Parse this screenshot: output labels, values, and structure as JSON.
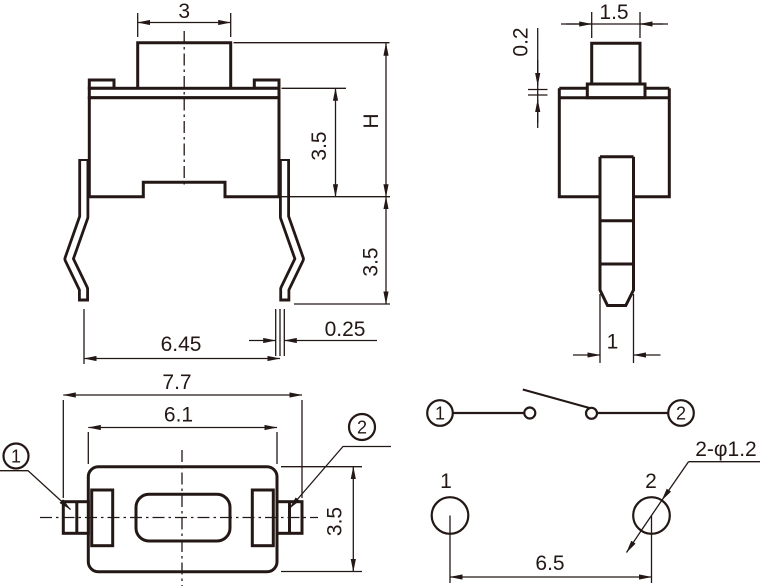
{
  "title": "Tact switch dimensional drawing",
  "colors": {
    "line": "#231815",
    "background": "#ffffff"
  },
  "front_view": {
    "button_width": "3",
    "upper_body_height": "3.5",
    "total_height": "H",
    "leg_length": "3.5",
    "lead_span": "6.45",
    "lead_thickness": "0.25"
  },
  "side_view": {
    "button_width": "1.5",
    "clearance": "0.2",
    "pin_width": "1"
  },
  "plan_view": {
    "overall_width": "7.7",
    "body_width": "6.1",
    "body_depth": "3.5",
    "terminal_1": "1",
    "terminal_2": "2"
  },
  "schematic": {
    "terminal_1": "1",
    "terminal_2": "2"
  },
  "footprint": {
    "pad_1": "1",
    "pad_2": "2",
    "hole_callout": "2-φ1.2",
    "pad_pitch": "6.5"
  }
}
